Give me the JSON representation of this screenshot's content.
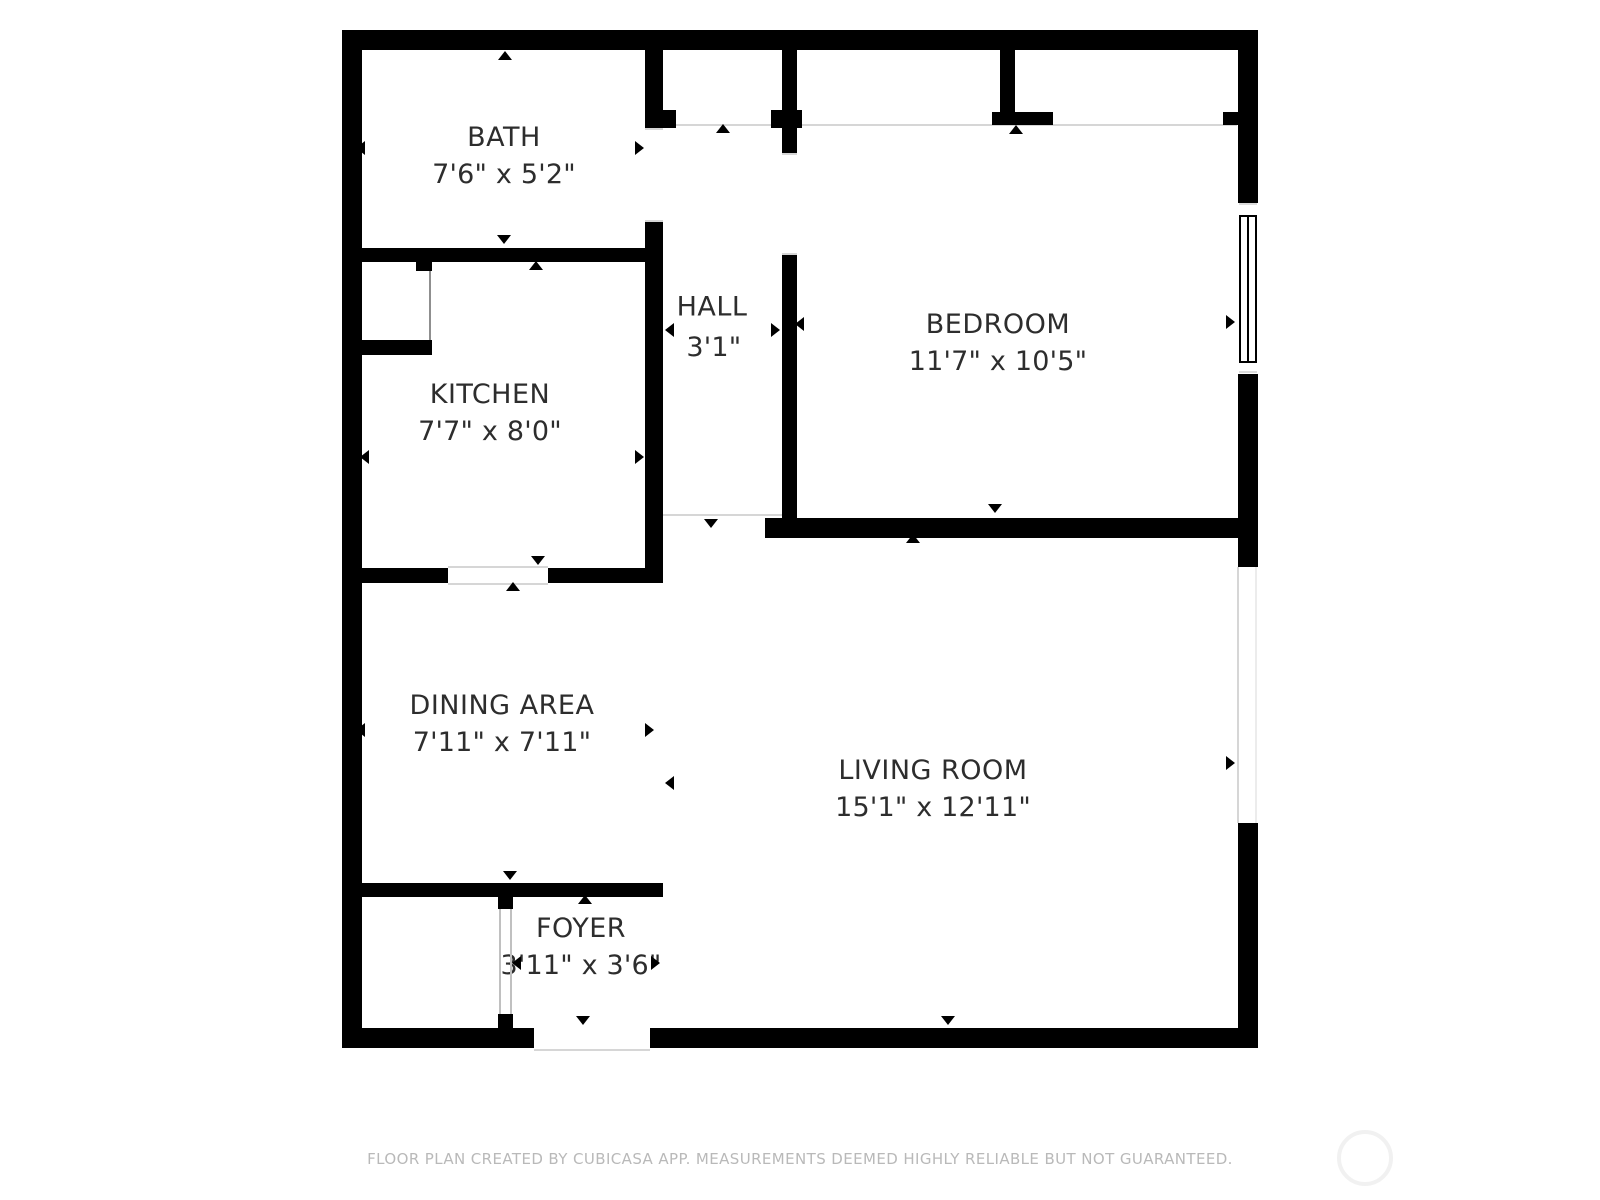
{
  "floor_plan": {
    "rooms": [
      {
        "id": "bath",
        "name": "BATH",
        "dimensions": "7'6\" x 5'2\""
      },
      {
        "id": "kitchen",
        "name": "KITCHEN",
        "dimensions": "7'7\" x 8'0\""
      },
      {
        "id": "hall",
        "name": "HALL",
        "dimensions": "3'1\" x 10'9\""
      },
      {
        "id": "bedroom",
        "name": "BEDROOM",
        "dimensions": "11'7\" x 10'5\""
      },
      {
        "id": "dining-area",
        "name": "DINING AREA",
        "dimensions": "7'11\" x 7'11\""
      },
      {
        "id": "living-room",
        "name": "LIVING ROOM",
        "dimensions": "15'1\" x 12'11\""
      },
      {
        "id": "foyer",
        "name": "FOYER",
        "dimensions": "3'11\" x 3'6\""
      }
    ],
    "footer_text": "FLOOR PLAN CREATED BY CUBICASA APP. MEASUREMENTS DEEMED HIGHLY RELIABLE BUT NOT GUARANTEED.",
    "colors": {
      "wall": "#000000",
      "room_text": "#2d2d2d",
      "footer_text": "#b9b9b9",
      "thin_line": "#d6d6d6",
      "background": "#ffffff"
    }
  }
}
